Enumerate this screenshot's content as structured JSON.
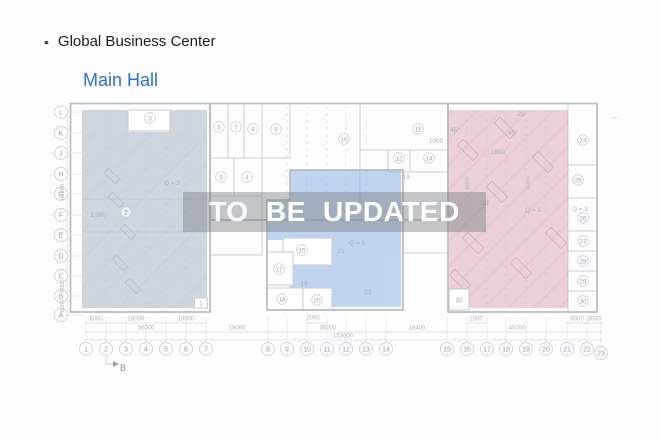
{
  "header": {
    "bullet": "•",
    "title": "Global Business Center"
  },
  "subheader": {
    "title": "Main Hall",
    "color": "#2970d6"
  },
  "watermark": {
    "text": "TO BE UPDATED",
    "text_color": "#ffffff"
  },
  "plan": {
    "grid_rows": [
      "L",
      "K",
      "J",
      "H",
      "G",
      "F",
      "E",
      "D",
      "C",
      "B",
      "A"
    ],
    "grid_columns": [
      "1",
      "2",
      "3",
      "4",
      "5",
      "6",
      "7",
      "8",
      "9",
      "10",
      "11",
      "12",
      "13",
      "14",
      "15",
      "16",
      "17",
      "18",
      "19",
      "20",
      "21",
      "22",
      "23"
    ],
    "room_bubbles": [
      "3",
      "6",
      "7",
      "8",
      "9",
      "5",
      "4",
      "2",
      "10",
      "11",
      "12",
      "14",
      "15",
      "17",
      "18",
      "20",
      "24",
      "25",
      "26",
      "27",
      "28",
      "29",
      "30"
    ],
    "labels": [
      "13",
      "19",
      "21",
      "22",
      "23",
      "31",
      "Q = 3",
      "Q = 3",
      "Q = 3",
      "Q = 3",
      "45°",
      "45°",
      "1000",
      "1800",
      "2,000"
    ],
    "boxed_labels": [
      "1",
      "32"
    ],
    "dim_labels": [
      "6000",
      "18000",
      "18000",
      "2000",
      "1300",
      "6000",
      "3000",
      "36000",
      "18000",
      "36000",
      "18400",
      "45000",
      "153600"
    ],
    "dim_rot": [
      "60000",
      "6000",
      "6000",
      "6000",
      "6000"
    ],
    "section_marker": "B",
    "colors": {
      "left_zone": "#a8b8c8",
      "middle_zone": "#8fb3e6",
      "right_zone": "#dba6b9"
    }
  }
}
